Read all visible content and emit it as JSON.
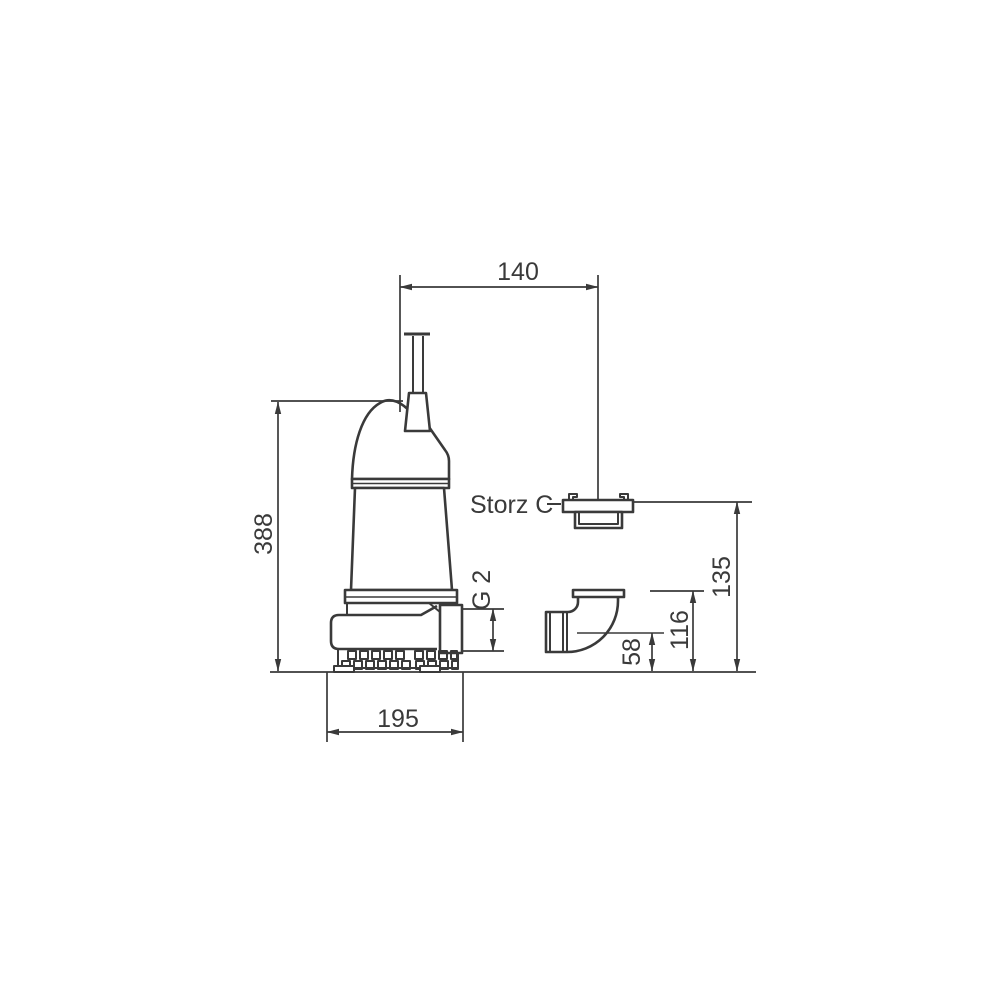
{
  "drawing": {
    "background_color": "#ffffff",
    "line_color": "#3a3a3a",
    "labels": {
      "coupling_type": "Storz C",
      "discharge_thread": "G 2"
    },
    "dimensions": {
      "axis_to_coupling_width": "140",
      "overall_height": "388",
      "base_width": "195",
      "elbow_centerline_height": "58",
      "elbow_top_height": "116",
      "coupling_height": "135"
    }
  }
}
